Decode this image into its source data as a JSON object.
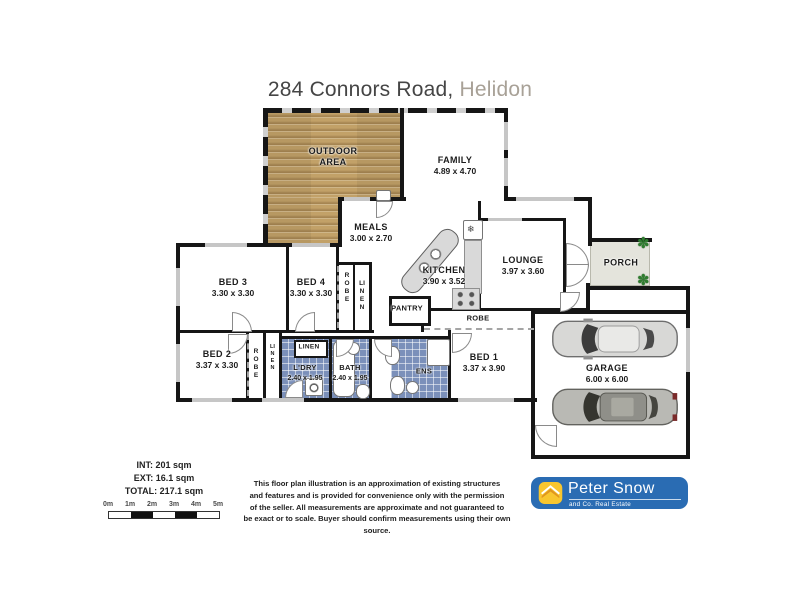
{
  "title": {
    "address": "284 Connors Road,",
    "suburb": "Helidon"
  },
  "rooms": {
    "outdoor": {
      "name": "OUTDOOR\nAREA"
    },
    "family": {
      "name": "FAMILY",
      "dims": "4.89 x 4.70"
    },
    "meals": {
      "name": "MEALS",
      "dims": "3.00 x 2.70"
    },
    "kitchen": {
      "name": "KITCHEN",
      "dims": "3.90 x 3.52"
    },
    "lounge": {
      "name": "LOUNGE",
      "dims": "3.97 x 3.60"
    },
    "porch": {
      "name": "PORCH"
    },
    "pantry": {
      "name": "PANTRY"
    },
    "garage": {
      "name": "GARAGE",
      "dims": "6.00 x 6.00"
    },
    "bed1": {
      "name": "BED 1",
      "dims": "3.37 x 3.90"
    },
    "bed2": {
      "name": "BED 2",
      "dims": "3.37 x 3.30"
    },
    "bed3": {
      "name": "BED 3",
      "dims": "3.30 x 3.30"
    },
    "bed4": {
      "name": "BED 4",
      "dims": "3.30 x 3.30"
    },
    "ldry": {
      "name": "L'DRY",
      "dims": "2.40 x 1.95"
    },
    "bath": {
      "name": "BATH",
      "dims": "2.40 x 1.95"
    },
    "ens": {
      "name": "ENS"
    },
    "robe": "ROBE",
    "linen": "LINEN"
  },
  "areas": {
    "int": "INT: 201 sqm",
    "ext": "EXT: 16.1 sqm",
    "total": "TOTAL: 217.1 sqm"
  },
  "scale": {
    "labels": [
      "0m",
      "1m",
      "2m",
      "3m",
      "4m",
      "5m"
    ]
  },
  "footer": {
    "disclaimer": "This floor plan illustration is an approximation of existing structures\nand features and is provided for convenience only with the permission\nof the seller. All measurements are approximate and not guaranteed to\nbe exact or to scale. Buyer should confirm measurements using their own source."
  },
  "logo": {
    "name": "Peter Snow",
    "tagline": "and Co. Real Estate"
  },
  "colors": {
    "wood": "#c2a168",
    "tile": "#7b90ba",
    "porch_fill": "#e4e4dc",
    "logo_blue": "#2a6cb3",
    "logo_yellow": "#f8c62f"
  },
  "icons": {
    "plant": "✽",
    "fridge": "❄"
  }
}
